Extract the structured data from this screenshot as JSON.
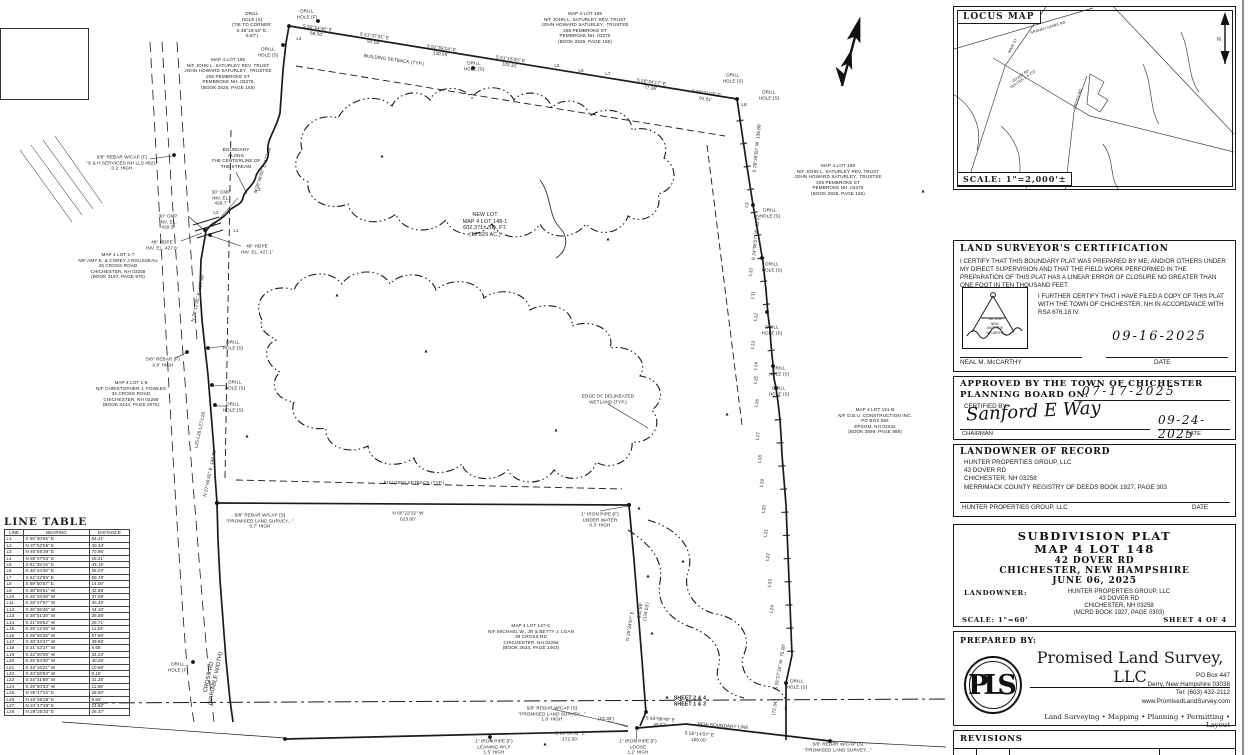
{
  "locus": {
    "title": "LOCUS MAP",
    "scale": "SCALE: 1\"=2,000'±"
  },
  "cert": {
    "title": "LAND SURVEYOR'S CERTIFICATION",
    "para1": "I CERTIFY THAT THIS BOUNDARY PLAT WAS PREPARED BY ME, AND/OR OTHERS UNDER MY DIRECT SUPERVISION AND THAT THE FIELD WORK PERFORMED IN THE PREPARATION OF THIS PLAT HAS A LINEAR ERROR OF CLOSURE NO GREATER THAN ONE FOOT IN TEN THOUSAND FEET.",
    "para2": "I FURTHER CERTIFY THAT I HAVE FILED A COPY OF THIS PLAT WITH THE TOWN OF CHICHESTER, NH IN ACCORDANCE WITH RSA 676.18 IV.",
    "seal_no": "No. 1199",
    "seal_name1": "NEAL",
    "seal_name2": "MATTHEW",
    "seal_name3": "McCARTHY",
    "date": "09-16-2025",
    "signature_name": "NEAL M. McCARTHY",
    "date_label": "DATE"
  },
  "approval": {
    "title_line1": "APPROVED BY THE TOWN OF CHICHESTER",
    "title_line2": "PLANNING BOARD ON:",
    "approved_date": "07-17-2025",
    "certified_by_label": "CERTIFIED BY:",
    "signature": "Sanford E Way",
    "role": "CHAIRMAN",
    "signed_date": "09-24-2025",
    "date_label": "DATE"
  },
  "landowner_record": {
    "title": "LANDOWNER OF RECORD",
    "lines": [
      "HUNTER PROPERTIES GROUP, LLC",
      "43 DOVER RD",
      "CHICHESTER, NH 03258",
      "MERRIMACK COUNTY REGISTRY OF DEEDS BOOK 1927, PAGE 303"
    ],
    "signature_name": "HUNTER PROPERTIES GROUP, LLC",
    "date_label": "DATE"
  },
  "title_block": {
    "line1": "SUBDIVISION PLAT",
    "line2": "MAP 4 LOT 148",
    "line3": "42 DOVER RD",
    "line4": "CHICHESTER, NEW HAMPSHIRE",
    "line5": "JUNE 06, 2025",
    "landowner_label": "LANDOWNER:",
    "landowner_lines": [
      "HUNTER PROPERTIES GROUP, LLC",
      "43 DOVER RD",
      "CHICHESTER, NH 03258",
      "(MCRD BOOK 1927, PAGE 0303)"
    ],
    "scale": "SCALE: 1\"=60'",
    "sheet": "SHEET 4 OF 4"
  },
  "prepared_by": {
    "label": "PREPARED BY:",
    "logo": "PLS",
    "company": "Promised Land Survey, LLC",
    "address": [
      "PO Box 447",
      "Derry, New Hampshire 03038",
      "Tel: (603) 432-2112",
      "www.PromisedLandSurvey.com"
    ],
    "services": "Land Surveying  • Mapping  • Planning  • Permitting  • Layout"
  },
  "revisions": {
    "title": "REVISIONS"
  },
  "line_table": {
    "title": "LINE TABLE",
    "columns": [
      "LINE",
      "BEARING",
      "DISTANCE"
    ],
    "rows": [
      [
        "L1",
        "S 60°30'55\" E",
        "84.41'"
      ],
      [
        "L2",
        "N 37°52'55\" E",
        "40.34'"
      ],
      [
        "L3",
        "N 40°56'39\" E",
        "70.96'"
      ],
      [
        "L4",
        "N 59°07'04\" E",
        "19.31'"
      ],
      [
        "L5",
        "S 51°35'16\" E",
        "43.15'"
      ],
      [
        "L6",
        "S 48°44'36\" E",
        "28.03'"
      ],
      [
        "L7",
        "S 52°42'59\" E",
        "59.78'"
      ],
      [
        "L8",
        "S 69°50'57\" E",
        "14.00'"
      ],
      [
        "L9",
        "S 30°56'51\" W",
        "42.66'"
      ],
      [
        "L10",
        "S 25°28'48\" W",
        "37.06'"
      ],
      [
        "L11",
        "S 28°47'57\" W",
        "30.46'"
      ],
      [
        "L12",
        "S 30°38'45\" W",
        "44.10'"
      ],
      [
        "L13",
        "S 28°01'20\" W",
        "38.88'"
      ],
      [
        "L14",
        "S 21°29'52\" W",
        "29.71'"
      ],
      [
        "L15",
        "S 29°12'45\" W",
        "11.54'"
      ],
      [
        "L16",
        "S 25°46'25\" W",
        "57.90'"
      ],
      [
        "L17",
        "S 28°33'47\" W",
        "39.96'"
      ],
      [
        "L18",
        "S 21°43'17\" W",
        "8.65'"
      ],
      [
        "L19",
        "S 22°20'08\" W",
        "34.22'"
      ],
      [
        "L20",
        "S 25°54'30\" W",
        "40.25'"
      ],
      [
        "L21",
        "S 33°16'21\" W",
        "10.68'"
      ],
      [
        "L22",
        "S 33°26'53\" W",
        "9.15'"
      ],
      [
        "L23",
        "S 24°31'58\" W",
        "31.25'"
      ],
      [
        "L24",
        "S 29°00'33\" W",
        "11.98'"
      ],
      [
        "L25",
        "N 26°47'22\" E",
        "28.92'"
      ],
      [
        "L26",
        "N 16°36'38\" E",
        "8.83'"
      ],
      [
        "L27",
        "N 24°47'28\" E",
        "24.82'"
      ],
      [
        "L28",
        "N 29°25'33\" E",
        "26.37'"
      ]
    ]
  },
  "plat": {
    "labels": [
      {
        "n": "drill-hole-label",
        "t": "DRILL\nHOLE (S)\n(TIE TO CORNER:\nS 48°16'43\" E,\n8.87')",
        "x": 252,
        "y": 25
      },
      {
        "n": "drill-hole-label",
        "t": "DRILL\nHOLE (F)",
        "x": 307,
        "y": 14
      },
      {
        "n": "line-number-label",
        "t": "L4",
        "x": 299,
        "y": 39
      },
      {
        "n": "drill-hole-label",
        "t": "DRILL\nHOLE (S)",
        "x": 268,
        "y": 52
      },
      {
        "n": "bearing-label",
        "t": "S 50°54'46\" E\n68.50'",
        "x": 317,
        "y": 31,
        "r": 8
      },
      {
        "n": "bearing-label",
        "t": "S 51°37'31\" E\n91.08'",
        "x": 374,
        "y": 39,
        "r": 8
      },
      {
        "n": "bearing-label",
        "t": "S 52°59'24\" E\n130.55'",
        "x": 441,
        "y": 51,
        "r": 8
      },
      {
        "n": "setback-label",
        "t": "BUILDING SETBACK (TYP.)",
        "x": 394,
        "y": 60,
        "r": 8
      },
      {
        "n": "drill-hole-label",
        "t": "DRILL\nHOLE (S)",
        "x": 474,
        "y": 66
      },
      {
        "n": "bearing-label",
        "t": "S 51°16'35\" E\n103.31'",
        "x": 510,
        "y": 62,
        "r": 8
      },
      {
        "n": "line-number-label",
        "t": "L5",
        "x": 557,
        "y": 66
      },
      {
        "n": "line-number-label",
        "t": "L6",
        "x": 581,
        "y": 71
      },
      {
        "n": "line-number-label",
        "t": "L7",
        "x": 608,
        "y": 74
      },
      {
        "n": "bearing-label",
        "t": "S 50°54'17\" E\n77.36'",
        "x": 651,
        "y": 85,
        "r": 8
      },
      {
        "n": "bearing-label",
        "t": "S 50°21'15\" E\n91.61'",
        "x": 706,
        "y": 96,
        "r": 8
      },
      {
        "n": "drill-hole-label",
        "t": "DRILL\nHOLE (S)",
        "x": 733,
        "y": 78
      },
      {
        "n": "drill-hole-label",
        "t": "DRILL\nHOLE (S)",
        "x": 769,
        "y": 95
      },
      {
        "n": "line-number-label",
        "t": "L8",
        "x": 744,
        "y": 105
      },
      {
        "n": "abutter-label",
        "t": "MAP 4 LOT 169\nN/F JOHN L. SATURLEY REV. TRUST\nJOHN HOWARD SATURLEY,  TRUSTEE\n255 PEMBROKE ST\nPEMBROKE NH, 03275\n(BOOK 2825, PAGE 165)",
        "x": 228,
        "y": 74
      },
      {
        "n": "abutter-label",
        "t": "MAP 4 LOT 169\nN/F JOHN L. SATURLEY REV. TRUST\nJOHN HOWARD SATURLEY,  TRUSTEE\n255 PEMBROKE ST\nPEMBROKE NH, 03275\n(BOOK 2825, PAGE 165)",
        "x": 585,
        "y": 28
      },
      {
        "n": "abutter-label",
        "t": "MAP 4 LOT 169\nN/F JOHN L. SATURLEY REV. TRUST\nJOHN HOWARD SATURLEY,  TRUSTEE\n255 PEMBROKE ST\nPEMBROKE NH, 03275\n(BOOK 2825, PAGE 165)",
        "x": 838,
        "y": 180
      },
      {
        "n": "monument-label",
        "t": "5/8\" REBAR W/CAP (F)\n\"S & H SERVICES NH LLS #821\"\n0.2' HIGH",
        "x": 122,
        "y": 163
      },
      {
        "n": "stream-label",
        "t": "BOUNDARY\nALONG\nTHE CENTERLINE OF\nTHE STREAM",
        "x": 236,
        "y": 158
      },
      {
        "n": "culvert-label",
        "t": "30\" CMP\nINV. EL.\n428.7'",
        "x": 221,
        "y": 198
      },
      {
        "n": "culvert-label",
        "t": "30\" CMP\nINV. EL.\n429.5'",
        "x": 168,
        "y": 222
      },
      {
        "n": "culvert-label",
        "t": "48\" HDPE\nINV. EL. 427.6'",
        "x": 162,
        "y": 245
      },
      {
        "n": "culvert-label",
        "t": "48\" HDPE\nINV. EL. 427.1'",
        "x": 257,
        "y": 249
      },
      {
        "n": "bearing-label",
        "t": "N 26°48'00\" E  177.94'",
        "x": 263,
        "y": 170,
        "r": -72
      },
      {
        "n": "line-number-label",
        "t": "L1",
        "x": 236,
        "y": 231
      },
      {
        "n": "line-number-label",
        "t": "L2",
        "x": 216,
        "y": 213
      },
      {
        "n": "line-number-label",
        "t": "L3",
        "x": 258,
        "y": 190
      },
      {
        "n": "abutter-label",
        "t": "MAP 4 LOT 1-7\nN/F AMY E. & COREY J ROUSSEAU\n26 CROSS ROAD\nCHICHESTER, NH 03258\n(BOOK 3197, PAGE 970)",
        "x": 118,
        "y": 266
      },
      {
        "n": "bearing-label",
        "t": "N 26°12'35\" E  187.69'",
        "x": 198,
        "y": 298,
        "r": -78
      },
      {
        "n": "monument-label",
        "t": "5/8\" REBAR (F)\n0.9' HIGH",
        "x": 163,
        "y": 362
      },
      {
        "n": "abutter-label",
        "t": "MAP 4 LOT 1-8\nN/F CHRISTOPHER J. FOWLES\n32 CROSS ROAD\nCHICHESTER, NH 03258\n(BOOK 3444, PAGE 2075)",
        "x": 131,
        "y": 394
      },
      {
        "n": "drill-hole-label",
        "t": "DRILL\nHOLE (S)",
        "x": 233,
        "y": 345
      },
      {
        "n": "drill-hole-label",
        "t": "DRILL\nHOLE (S)",
        "x": 235,
        "y": 385
      },
      {
        "n": "drill-hole-label",
        "t": "DRILL\nHOLE (S)",
        "x": 233,
        "y": 407
      },
      {
        "n": "line-number-label",
        "t": "L25-L26-L27-L28",
        "x": 200,
        "y": 430,
        "r": -78
      },
      {
        "n": "new-lot-label",
        "t": "NEW LOT\nMAP 4 LOT 148-1\n602,371± SQ. FT.\n(13.829 AC.)",
        "x": 485,
        "y": 225,
        "s": 5.4
      },
      {
        "n": "wetland-label",
        "t": "EDGE OF DELINEATED\nWETLAND (TYP.)",
        "x": 608,
        "y": 399
      },
      {
        "n": "setback-label",
        "t": "BUILDING SETBACK (TYP.)",
        "x": 414,
        "y": 483
      },
      {
        "n": "bearing-label",
        "t": "S 26°38'50\" W  138.89'",
        "x": 757,
        "y": 148,
        "r": -84
      },
      {
        "n": "line-number-label",
        "t": "L9",
        "x": 747,
        "y": 205,
        "r": -80
      },
      {
        "n": "drill-hole-label",
        "t": "DRILL\nHOLE (S)",
        "x": 770,
        "y": 213
      },
      {
        "n": "bearing-label",
        "t": "S 24°56'07\" W  61.22'",
        "x": 756,
        "y": 237,
        "r": -84
      },
      {
        "n": "drill-hole-label",
        "t": "DRILL\nHOLE (S)",
        "x": 772,
        "y": 267
      },
      {
        "n": "line-number-label",
        "t": "L10",
        "x": 751,
        "y": 272,
        "r": -80
      },
      {
        "n": "line-number-label",
        "t": "L11",
        "x": 753,
        "y": 295,
        "r": -80
      },
      {
        "n": "line-number-label",
        "t": "L12",
        "x": 756,
        "y": 317,
        "r": -80
      },
      {
        "n": "drill-hole-label",
        "t": "DRILL\nHOLE (S)",
        "x": 772,
        "y": 330
      },
      {
        "n": "line-number-label",
        "t": "L13",
        "x": 753,
        "y": 345,
        "r": -80
      },
      {
        "n": "line-number-label",
        "t": "L14",
        "x": 756,
        "y": 366,
        "r": -80
      },
      {
        "n": "drill-hole-label",
        "t": "DRILL\nHOLE (S)",
        "x": 779,
        "y": 371
      },
      {
        "n": "line-number-label",
        "t": "L15",
        "x": 756,
        "y": 380,
        "r": -80
      },
      {
        "n": "drill-hole-label",
        "t": "DRILL\nHOLE (S)",
        "x": 779,
        "y": 391
      },
      {
        "n": "line-number-label",
        "t": "L16",
        "x": 757,
        "y": 403,
        "r": -80
      },
      {
        "n": "line-number-label",
        "t": "L17",
        "x": 758,
        "y": 436,
        "r": -80
      },
      {
        "n": "line-number-label",
        "t": "L18",
        "x": 760,
        "y": 459,
        "r": -80
      },
      {
        "n": "line-number-label",
        "t": "L19",
        "x": 762,
        "y": 483,
        "r": -80
      },
      {
        "n": "line-number-label",
        "t": "L20",
        "x": 764,
        "y": 509,
        "r": -80
      },
      {
        "n": "line-number-label",
        "t": "L21",
        "x": 766,
        "y": 533,
        "r": -80
      },
      {
        "n": "line-number-label",
        "t": "L22",
        "x": 768,
        "y": 557,
        "r": -80
      },
      {
        "n": "line-number-label",
        "t": "L23",
        "x": 770,
        "y": 583,
        "r": -80
      },
      {
        "n": "line-number-label",
        "t": "L24",
        "x": 772,
        "y": 609,
        "r": -80
      },
      {
        "n": "abutter-label",
        "t": "MAP 4 LOT 151-B\nN/F D.B.U. CONSTRUCTION INC.\nPO BOX 984\nEPSOM, NH 03234\n(BOOK 3599, PAGE 869)",
        "x": 875,
        "y": 421
      },
      {
        "n": "monument-label",
        "t": "5/8\" REBAR W/CAP (S)\n\"PROMISED LAND SURVEY...\"\n0.7' HIGH",
        "x": 260,
        "y": 521
      },
      {
        "n": "bearing-label",
        "t": "N 60°22'22\" W\n623.00'",
        "x": 408,
        "y": 516
      },
      {
        "n": "monument-label",
        "t": "1\" IRON PIPE (F)\nUNDER WATER\n0.3' HIGH",
        "x": 600,
        "y": 520
      },
      {
        "n": "abutter-label",
        "t": "MAP 4 LOT 147-C\nN/F MICHAEL W., JR & BETTY J. LOAN\n39 CROSS RD\nCHICHESTER, NH 03258\n(BOOK 3634, PAGE 1463)",
        "x": 531,
        "y": 637
      },
      {
        "n": "bearing-label",
        "t": "N 26°34'57\" E",
        "x": 630,
        "y": 626,
        "r": -80
      },
      {
        "n": "bearing-label",
        "t": "350.88'\n(134.53')",
        "x": 643,
        "y": 611,
        "r": -80
      },
      {
        "n": "bearing-label",
        "t": "N 27°46'45\" E  146.85'",
        "x": 210,
        "y": 473,
        "r": -78
      },
      {
        "n": "road-label",
        "t": "CROSS RD\n(VARIABLE WIDTH)",
        "x": 213,
        "y": 678,
        "r": -78,
        "s": 5.8
      },
      {
        "n": "drill-hole-label",
        "t": "DRILL\nHOLE (F)",
        "x": 178,
        "y": 667
      },
      {
        "n": "sheet-match-label",
        "t": "SHEET 2 & 4\nSHEET 1 & 3",
        "x": 690,
        "y": 702,
        "s": 5.2,
        "b": 1
      },
      {
        "n": "monument-label",
        "t": "5/8\" REBAR W/CAP (S)\n\"PROMISED LAND SURVEY...\"\n1.0' HIGH",
        "x": 552,
        "y": 714
      },
      {
        "n": "tie-label",
        "t": "(16.35')",
        "x": 606,
        "y": 719
      },
      {
        "n": "bearing-label",
        "t": "S 63°58'49\" E\n49.57'",
        "x": 660,
        "y": 722,
        "r": 4
      },
      {
        "n": "new-boundary-label",
        "t": "NEW BOUNDARY LINE",
        "x": 723,
        "y": 726,
        "r": 4
      },
      {
        "n": "bearing-label",
        "t": "S 55°14'07\" E\n159.00'",
        "x": 699,
        "y": 737,
        "r": 4
      },
      {
        "n": "bearing-label",
        "t": "S 60°04'09\" E\n172.50'",
        "x": 570,
        "y": 736
      },
      {
        "n": "monument-label",
        "t": "1\" IRON PIPE (F)\nLEANING W'LY\n1.5' HIGH",
        "x": 494,
        "y": 747
      },
      {
        "n": "monument-label",
        "t": "1\" IRON PIPE (F)\nLOOSE\n1.2' HIGH",
        "x": 638,
        "y": 747
      },
      {
        "n": "bearing-label",
        "t": "S 28°27'16\" W  75.00'",
        "x": 780,
        "y": 667,
        "r": -80
      },
      {
        "n": "drill-hole-label",
        "t": "DRILL\nHOLE (S)",
        "x": 797,
        "y": 684
      },
      {
        "n": "tie-label",
        "t": "(72.34')",
        "x": 775,
        "y": 707,
        "r": -80
      },
      {
        "n": "monument-label",
        "t": "5/8\" REBAR W/CAP (S)\n\"PROMISED LAND SURVEY...\"",
        "x": 838,
        "y": 747
      },
      {
        "n": "tree-symbol",
        "t": "▴",
        "x": 923,
        "y": 192,
        "s": 6
      },
      {
        "n": "tree-symbol",
        "t": "▴",
        "x": 727,
        "y": 415,
        "s": 6
      },
      {
        "n": "tree-symbol",
        "t": "▴",
        "x": 639,
        "y": 509,
        "s": 6
      },
      {
        "n": "tree-symbol",
        "t": "▴",
        "x": 648,
        "y": 577,
        "s": 6
      },
      {
        "n": "tree-symbol",
        "t": "▴",
        "x": 652,
        "y": 634,
        "s": 6
      },
      {
        "n": "tree-symbol",
        "t": "▴",
        "x": 667,
        "y": 698,
        "s": 6
      },
      {
        "n": "tree-symbol",
        "t": "▴",
        "x": 545,
        "y": 745,
        "s": 6
      },
      {
        "n": "tree-symbol",
        "t": "▴",
        "x": 247,
        "y": 437,
        "s": 6
      },
      {
        "n": "tree-symbol",
        "t": "▴",
        "x": 337,
        "y": 296,
        "s": 6
      },
      {
        "n": "tree-symbol",
        "t": "▴",
        "x": 426,
        "y": 352,
        "s": 6
      },
      {
        "n": "tree-symbol",
        "t": "▴",
        "x": 556,
        "y": 431,
        "s": 6
      },
      {
        "n": "tree-symbol",
        "t": "▴",
        "x": 683,
        "y": 562,
        "s": 6
      },
      {
        "n": "tree-symbol",
        "t": "▴",
        "x": 608,
        "y": 240,
        "s": 6
      },
      {
        "n": "tree-symbol",
        "t": "▴",
        "x": 382,
        "y": 157,
        "s": 6
      },
      {
        "n": "locus-road-label",
        "t": "GRANNY HOWE RD",
        "x": 1048,
        "y": 28,
        "r": -17,
        "s": 3.8
      },
      {
        "n": "locus-road-label",
        "t": "MAIN ST",
        "x": 1013,
        "y": 46,
        "r": -62,
        "s": 3.8
      },
      {
        "n": "locus-road-label",
        "t": "DOVER RD\nROUTES 4 & 202",
        "x": 1022,
        "y": 78,
        "r": -35,
        "s": 3.6
      },
      {
        "n": "locus-road-label",
        "t": "CROSS RD",
        "x": 1078,
        "y": 99,
        "r": -72,
        "s": 3.8
      },
      {
        "n": "north-label",
        "t": "N",
        "x": 1219,
        "y": 40,
        "s": 5
      }
    ]
  }
}
